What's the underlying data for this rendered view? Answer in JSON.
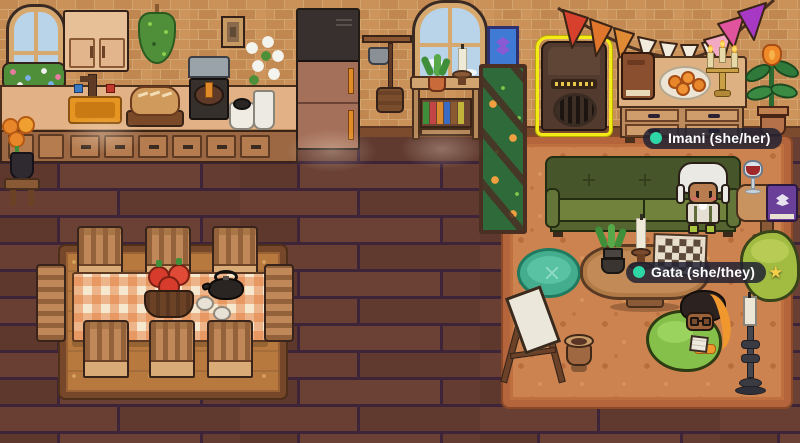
{
  "scene": {
    "name": "cozy-pixel-room",
    "width": 800,
    "height": 443
  },
  "players": {
    "imani": {
      "label": "Imani (she/her)",
      "status_dot_color": "#2fd6a5"
    },
    "gata": {
      "label": "Gata (she/they)",
      "status_dot_color": "#2fd6a5",
      "star": "★",
      "star_color": "#f6cf4a"
    }
  },
  "selection": {
    "object": "speaker",
    "outline_color": "#f4ea16"
  },
  "palette": {
    "brick": "#c58d55",
    "brick_mortar": "#d7ab7a",
    "floor_plank": "#63392f",
    "floor_gap": "#3d2438",
    "living_rug": "#cc8350",
    "living_rug_border": "#b4653c",
    "dining_rug": "#b8793f",
    "dining_rug_border": "#774729",
    "couch_green": "#71823c",
    "pouf_teal": "#43ad8d",
    "beanbag_green": "#84c04a",
    "tablecloth_orange": "#e27634",
    "bunting_colors": [
      "#d6402c",
      "#e0762b",
      "#e08a33",
      "#f2ecdf",
      "#f2a9c4",
      "#e0549d",
      "#a638c4"
    ]
  },
  "objects": [
    "arched-window",
    "flower-box",
    "upper-cabinet",
    "hanging-herbs",
    "wall-frame",
    "kitchen-counter",
    "sink",
    "bread-board",
    "coffee-machine",
    "crock-pot",
    "white-flower-vase",
    "fridge",
    "pot-rack",
    "console-bookshelf",
    "console-candle",
    "blue-picture-frame",
    "plant-trellis",
    "speaker",
    "party-bunting",
    "dresser",
    "brown-book",
    "plate-of-oranges",
    "candelabra",
    "potted-plant",
    "green-couch",
    "side-table",
    "wine-glass",
    "purple-book",
    "bean-bag",
    "teal-pouf",
    "coffee-table",
    "chessboard",
    "table-candle",
    "table-plant",
    "easel",
    "clay-pot",
    "floor-candlestick",
    "dining-table",
    "tomato-basket",
    "tea-kettle",
    "tea-cups",
    "dining-chairs",
    "marigold-vase",
    "living-rug",
    "dining-rug"
  ]
}
